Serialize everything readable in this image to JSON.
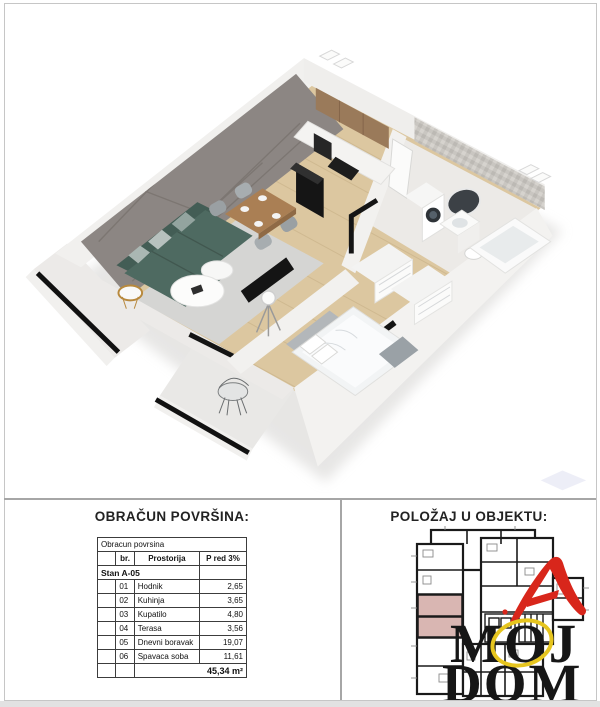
{
  "area_section": {
    "title": "OBRAČUN POVRŠINA:",
    "table": {
      "caption": "Obracun povrsina",
      "col_br": "br.",
      "col_room": "Prostorija",
      "col_area": "P red 3%",
      "group": "Stan A-05",
      "rows": [
        {
          "br": "01",
          "room": "Hodnik",
          "area": "2,65"
        },
        {
          "br": "02",
          "room": "Kuhinja",
          "area": "3,65"
        },
        {
          "br": "03",
          "room": "Kupatilo",
          "area": "4,80"
        },
        {
          "br": "04",
          "room": "Terasa",
          "area": "3,56"
        },
        {
          "br": "05",
          "room": "Dnevni boravak",
          "area": "19,07"
        },
        {
          "br": "06",
          "room": "Spavaca soba",
          "area": "11,61"
        }
      ],
      "total": "45,34 m²"
    }
  },
  "position_section": {
    "title": "POLOŽAJ U OBJEKTU:"
  },
  "logo": {
    "word1": "MOJ",
    "word2": "DOM"
  },
  "colors": {
    "unit_highlight": "#d9b6b2",
    "logo_red": "#d8261b",
    "logo_yellow": "#e6c51e",
    "sofa_teal": "#4e6a61",
    "feature_wall_gray": "#8c8683",
    "wood_floor": "#dcc7a0",
    "plan_line": "#1a1a1a"
  }
}
